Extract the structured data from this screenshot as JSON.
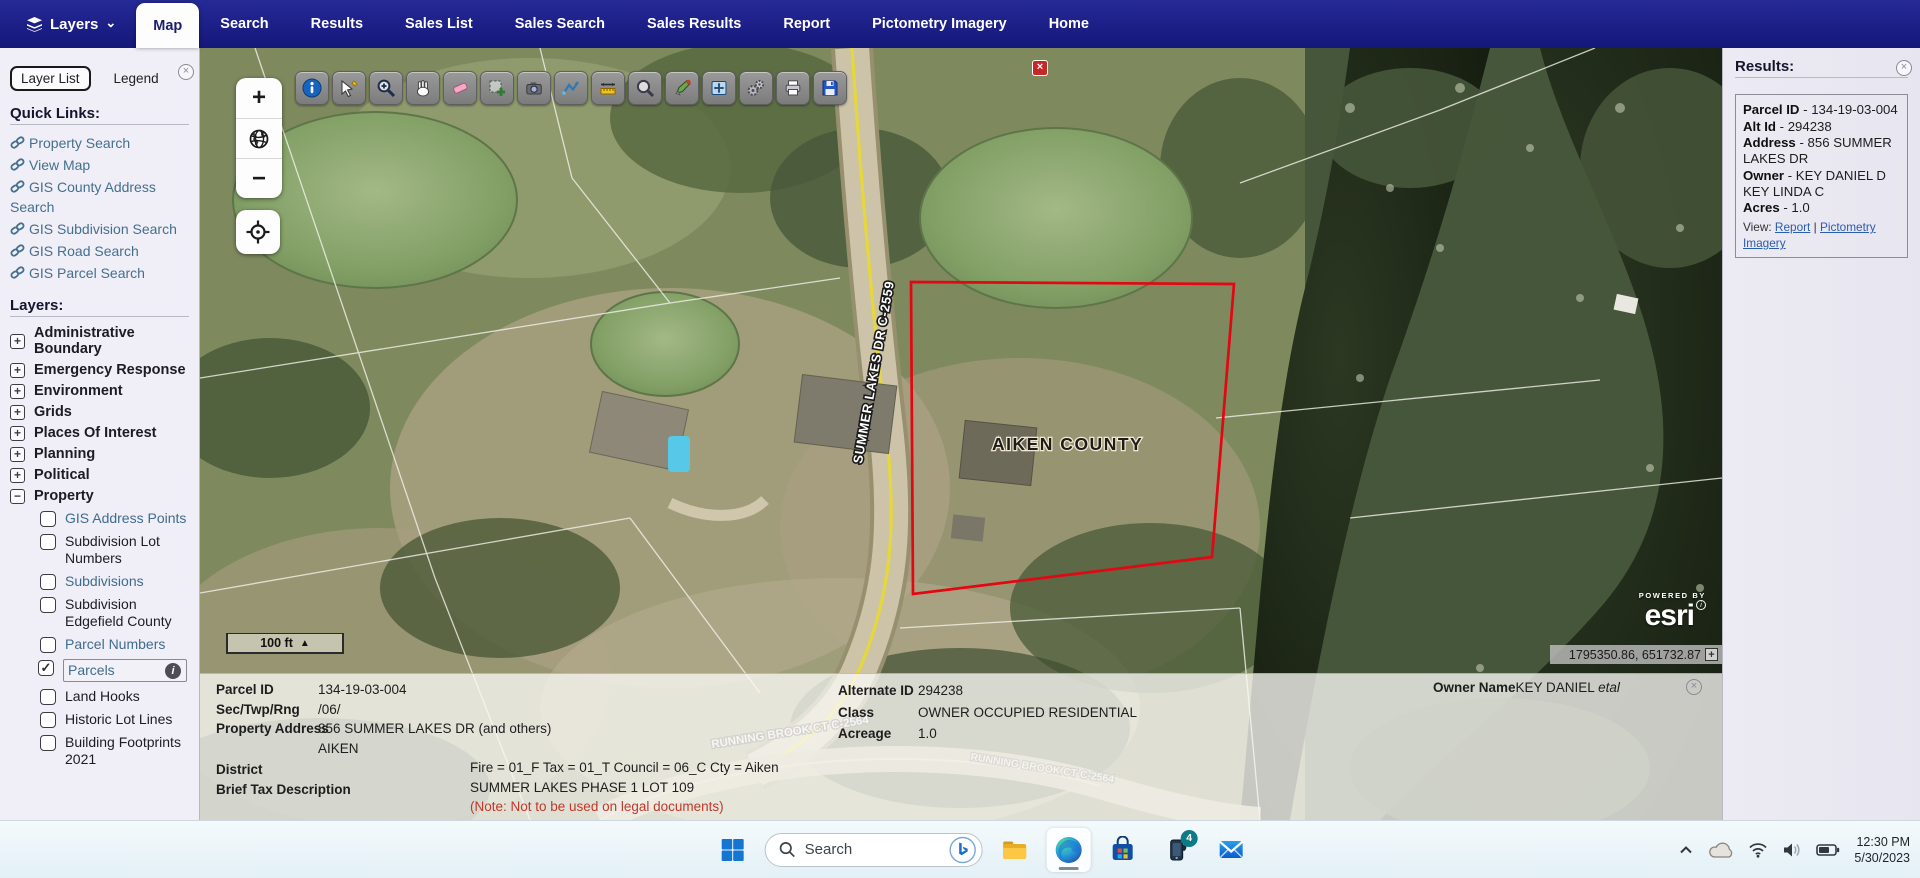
{
  "navbar": {
    "layers_label": "Layers",
    "tabs": [
      {
        "label": "Map",
        "active": true
      },
      {
        "label": "Search",
        "active": false
      },
      {
        "label": "Results",
        "active": false
      },
      {
        "label": "Sales List",
        "active": false
      },
      {
        "label": "Sales Search",
        "active": false
      },
      {
        "label": "Sales Results",
        "active": false
      },
      {
        "label": "Report",
        "active": false
      },
      {
        "label": "Pictometry Imagery",
        "active": false
      },
      {
        "label": "Home",
        "active": false
      }
    ]
  },
  "icons": {
    "close": "×",
    "chevron_down": "⌄",
    "check": "✓",
    "expand": "+",
    "collapse": "−",
    "info": "i",
    "scale_arrow": "▲",
    "plus_box": "+"
  },
  "sidebar": {
    "tabs": [
      "Layer List",
      "Legend"
    ],
    "quick_links_heading": "Quick Links:",
    "quick_links": [
      "Property Search",
      "View Map",
      "GIS County Address Search",
      "GIS Subdivision Search",
      "GIS Road Search",
      "GIS Parcel Search"
    ],
    "layers_heading": "Layers:",
    "layer_groups": [
      "Administrative Boundary",
      "Emergency Response",
      "Environment",
      "Grids",
      "Places Of Interest",
      "Planning",
      "Political",
      "Property"
    ],
    "property_sublayers": [
      {
        "label": "GIS Address Points",
        "checked": false,
        "link": true
      },
      {
        "label": "Subdivision Lot Numbers",
        "checked": false,
        "link": false
      },
      {
        "label": "Subdivisions",
        "checked": false,
        "link": true
      },
      {
        "label": "Subdivision Edgefield County",
        "checked": false,
        "link": false
      },
      {
        "label": "Parcel Numbers",
        "checked": false,
        "link": true
      },
      {
        "label": "Parcels",
        "checked": true,
        "link": true,
        "selected": true
      },
      {
        "label": "Land Hooks",
        "checked": false,
        "link": false
      },
      {
        "label": "Historic Lot Lines",
        "checked": false,
        "link": false
      },
      {
        "label": "Building Footprints 2021",
        "checked": false,
        "link": false
      }
    ]
  },
  "map": {
    "toolbar_tools": [
      "identify",
      "select-features",
      "zoom-to-selection",
      "pan",
      "erase",
      "add-selection",
      "screenshot",
      "measure-path",
      "measure-distance",
      "magnifier",
      "draw-marker",
      "full-extent",
      "link-gears",
      "print",
      "save"
    ],
    "zoom_in": "+",
    "zoom_out": "−",
    "scale_label": "100 ft",
    "county_label": "AIKEN COUNTY",
    "road_label": "SUMMER LAKES DR C-2559",
    "road_label_2": "RUNNING BROOK CT C-2564",
    "esri_powered_by": "POWERED BY",
    "esri_logo": "esri",
    "coordinates": "1795350.86, 651732.87",
    "parcel_outline_color": "#e30613"
  },
  "results_panel": {
    "title": "Results:",
    "sep": "-",
    "fields": [
      {
        "label": "Parcel ID",
        "value": "134-19-03-004"
      },
      {
        "label": "Alt Id",
        "value": "294238"
      },
      {
        "label": "Address",
        "value": "856 SUMMER LAKES DR"
      },
      {
        "label": "Owner",
        "value": "KEY DANIEL D KEY LINDA C"
      },
      {
        "label": "Acres",
        "value": "1.0"
      }
    ],
    "view_label": "View:",
    "link_sep": "|",
    "links": [
      "Report",
      "Pictometry Imagery"
    ]
  },
  "detail_panel": {
    "parcel_id_label": "Parcel ID",
    "parcel_id": "134-19-03-004",
    "sec_twp_rng_label": "Sec/Twp/Rng",
    "sec_twp_rng": "/06/",
    "property_address_label": "Property Address",
    "property_address": "856 SUMMER LAKES DR (and others)",
    "property_city": "AIKEN",
    "district_label": "District",
    "district": "Fire = 01_F Tax = 01_T Council = 06_C Cty = Aiken",
    "brief_tax_label": "Brief Tax Description",
    "brief_tax": "SUMMER LAKES PHASE 1 LOT 109",
    "note": "(Note: Not to be used on legal documents)",
    "alternate_id_label": "Alternate ID",
    "alternate_id": "294238",
    "class_label": "Class",
    "class_value": "OWNER OCCUPIED RESIDENTIAL",
    "acreage_label": "Acreage",
    "acreage": "1.0",
    "owner_name_label": "Owner Name",
    "owner_name": "KEY DANIEL ",
    "owner_suffix": "etal"
  },
  "taskbar": {
    "search_placeholder": "Search",
    "notification_badge": "4",
    "time": "12:30 PM",
    "date": "5/30/2023"
  }
}
